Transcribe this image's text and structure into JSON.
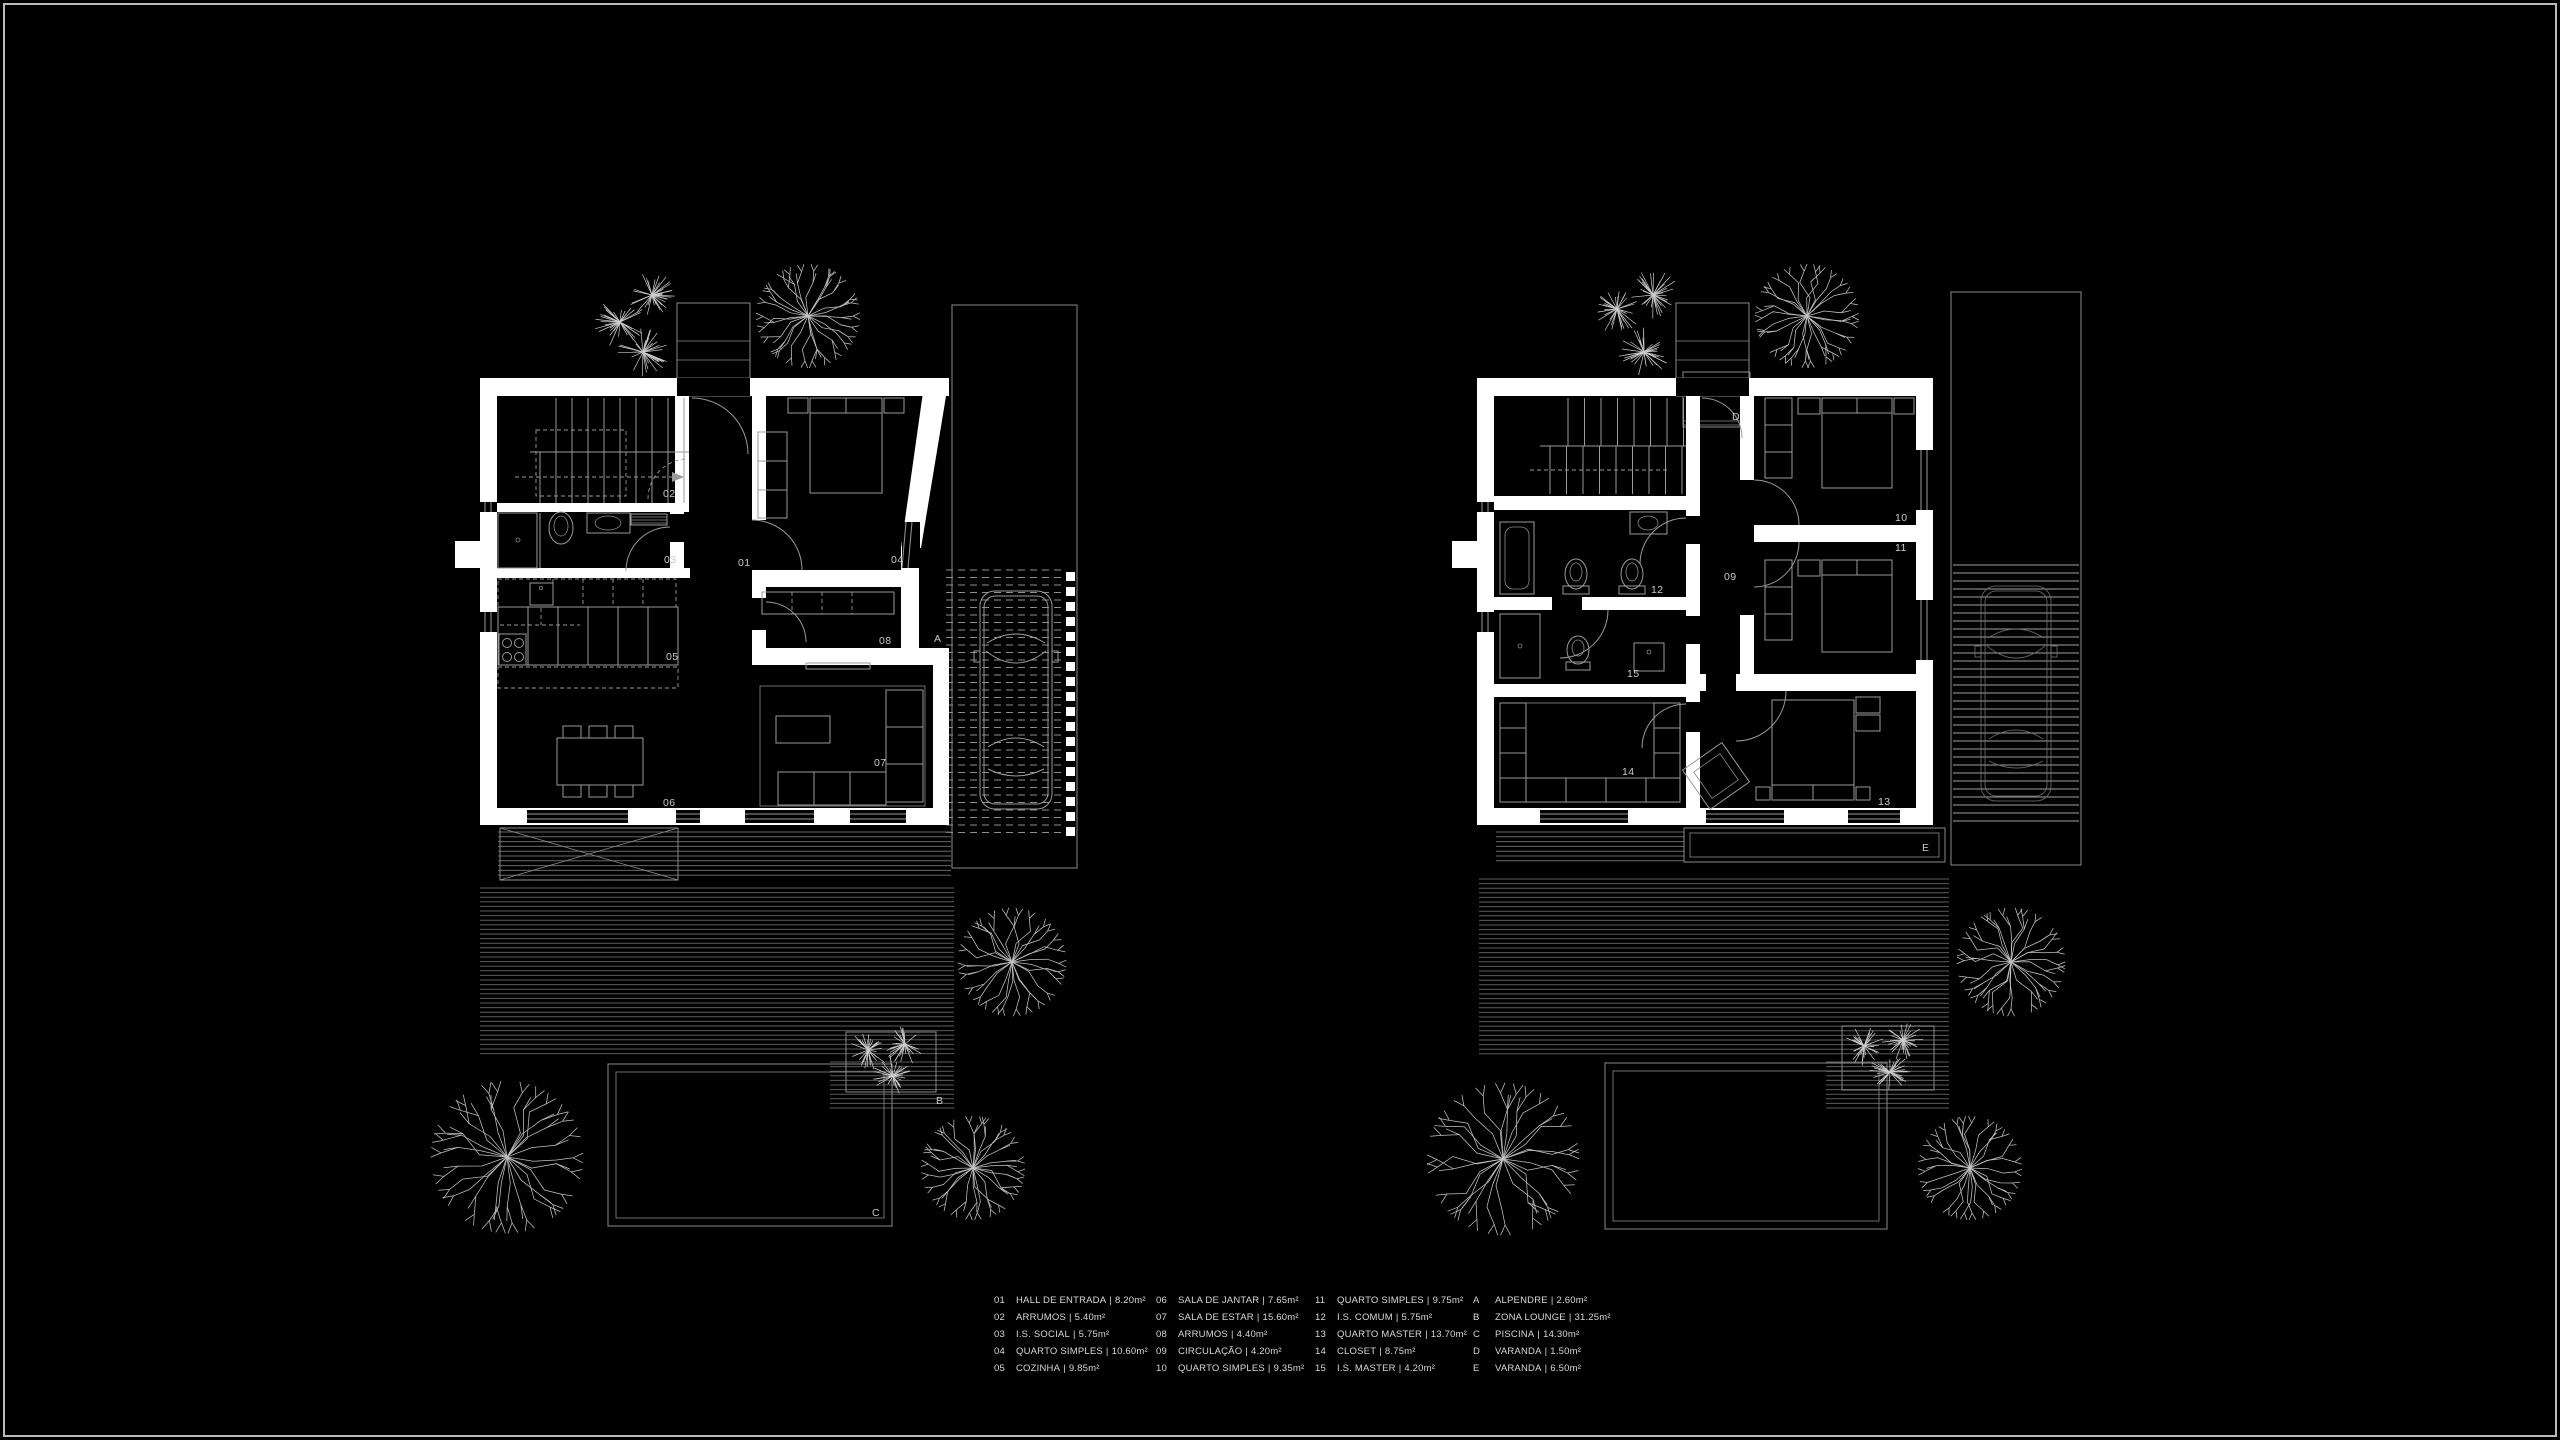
{
  "colors": {
    "background": "#000000",
    "frame": "#b9b9b9",
    "walls": "#ffffff",
    "furniture_lines": "#9a9a9a",
    "deck_lines": "#5c5c5c",
    "labels": "#c9c9c9",
    "legend_text": "#d8d8d8"
  },
  "plans": [
    {
      "id": "ground-floor",
      "labels": [
        {
          "text": "01",
          "x": 738,
          "y": 566
        },
        {
          "text": "02",
          "x": 663,
          "y": 497
        },
        {
          "text": "03",
          "x": 664,
          "y": 563
        },
        {
          "text": "04",
          "x": 891,
          "y": 563
        },
        {
          "text": "05",
          "x": 666,
          "y": 660
        },
        {
          "text": "06",
          "x": 663,
          "y": 806
        },
        {
          "text": "07",
          "x": 874,
          "y": 766
        },
        {
          "text": "08",
          "x": 879,
          "y": 644
        },
        {
          "text": "A",
          "x": 934,
          "y": 642
        },
        {
          "text": "B",
          "x": 936,
          "y": 1104
        },
        {
          "text": "C",
          "x": 872,
          "y": 1216
        }
      ]
    },
    {
      "id": "upper-floor",
      "labels": [
        {
          "text": "09",
          "x": 1724,
          "y": 580
        },
        {
          "text": "10",
          "x": 1895,
          "y": 521
        },
        {
          "text": "11",
          "x": 1895,
          "y": 551
        },
        {
          "text": "12",
          "x": 1651,
          "y": 593
        },
        {
          "text": "13",
          "x": 1878,
          "y": 805
        },
        {
          "text": "14",
          "x": 1622,
          "y": 775
        },
        {
          "text": "15",
          "x": 1627,
          "y": 677
        },
        {
          "text": "D",
          "x": 1732,
          "y": 420
        },
        {
          "text": "E",
          "x": 1922,
          "y": 851
        }
      ]
    }
  ],
  "legend": {
    "separator": "|",
    "columns": [
      {
        "items": [
          {
            "code": "01",
            "name": "HALL DE ENTRADA",
            "area": "8.20m²"
          },
          {
            "code": "02",
            "name": "ARRUMOS",
            "area": "5.40m²"
          },
          {
            "code": "03",
            "name": "I.S. SOCIAL",
            "area": "5.75m²"
          },
          {
            "code": "04",
            "name": "QUARTO SIMPLES",
            "area": "10.60m²"
          },
          {
            "code": "05",
            "name": "COZINHA",
            "area": "9.85m²"
          }
        ]
      },
      {
        "items": [
          {
            "code": "06",
            "name": "SALA DE JANTAR",
            "area": "7.65m²"
          },
          {
            "code": "07",
            "name": "SALA DE ESTAR",
            "area": "15.60m²"
          },
          {
            "code": "08",
            "name": "ARRUMOS",
            "area": "4.40m²"
          },
          {
            "code": "09",
            "name": "CIRCULAÇÃO",
            "area": "4.20m²"
          },
          {
            "code": "10",
            "name": "QUARTO SIMPLES",
            "area": "9.35m²"
          }
        ]
      },
      {
        "items": [
          {
            "code": "11",
            "name": "QUARTO SIMPLES",
            "area": "9.75m²"
          },
          {
            "code": "12",
            "name": "I.S. COMUM",
            "area": "5.75m²"
          },
          {
            "code": "13",
            "name": "QUARTO MASTER",
            "area": "13.70m²"
          },
          {
            "code": "14",
            "name": "CLOSET",
            "area": "8.75m²"
          },
          {
            "code": "15",
            "name": "I.S. MASTER",
            "area": "4.20m²"
          }
        ]
      },
      {
        "items": [
          {
            "code": "A",
            "name": "ALPENDRE",
            "area": "2.60m²"
          },
          {
            "code": "B",
            "name": "ZONA LOUNGE",
            "area": "31.25m²"
          },
          {
            "code": "C",
            "name": "PISCINA",
            "area": "14.30m²"
          },
          {
            "code": "D",
            "name": "VARANDA",
            "area": "1.50m²"
          },
          {
            "code": "E",
            "name": "VARANDA",
            "area": "6.50m²"
          }
        ]
      }
    ]
  }
}
